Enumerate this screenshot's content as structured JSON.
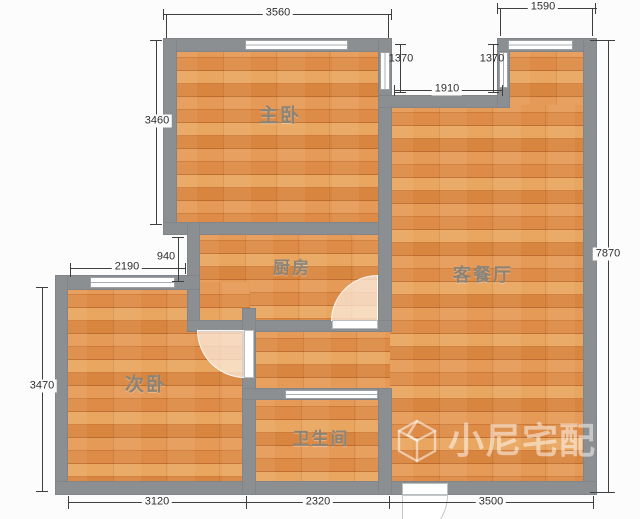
{
  "rooms": [
    {
      "id": "master-bedroom",
      "label": "主卧"
    },
    {
      "id": "kitchen",
      "label": "厨房"
    },
    {
      "id": "living-dining-room",
      "label": "客餐厅"
    },
    {
      "id": "second-bedroom",
      "label": "次卧"
    },
    {
      "id": "bathroom",
      "label": "卫生间"
    }
  ],
  "dimensions_mm": {
    "master_top_width": "3560",
    "top_right_width": "1590",
    "notch_left_depth": "1370",
    "notch_right_depth": "1370",
    "notch_width": "1910",
    "master_left_height": "3460",
    "service_notch_height": "940",
    "second_bedroom_top_width": "2190",
    "right_side_height": "7870",
    "second_bedroom_left_height": "3470",
    "bottom_left_width": "3120",
    "bottom_middle_width": "2320",
    "bottom_right_width": "3500"
  },
  "watermark": {
    "icon": "cube-logo-icon",
    "text": "小尼宅配"
  },
  "colors": {
    "wall": "#8c8f92",
    "floor": "#dd8746",
    "dimension_text": "#3f3f3f",
    "room_label": "#8a8478",
    "watermark_text": "rgba(255,255,255,0.5)"
  }
}
